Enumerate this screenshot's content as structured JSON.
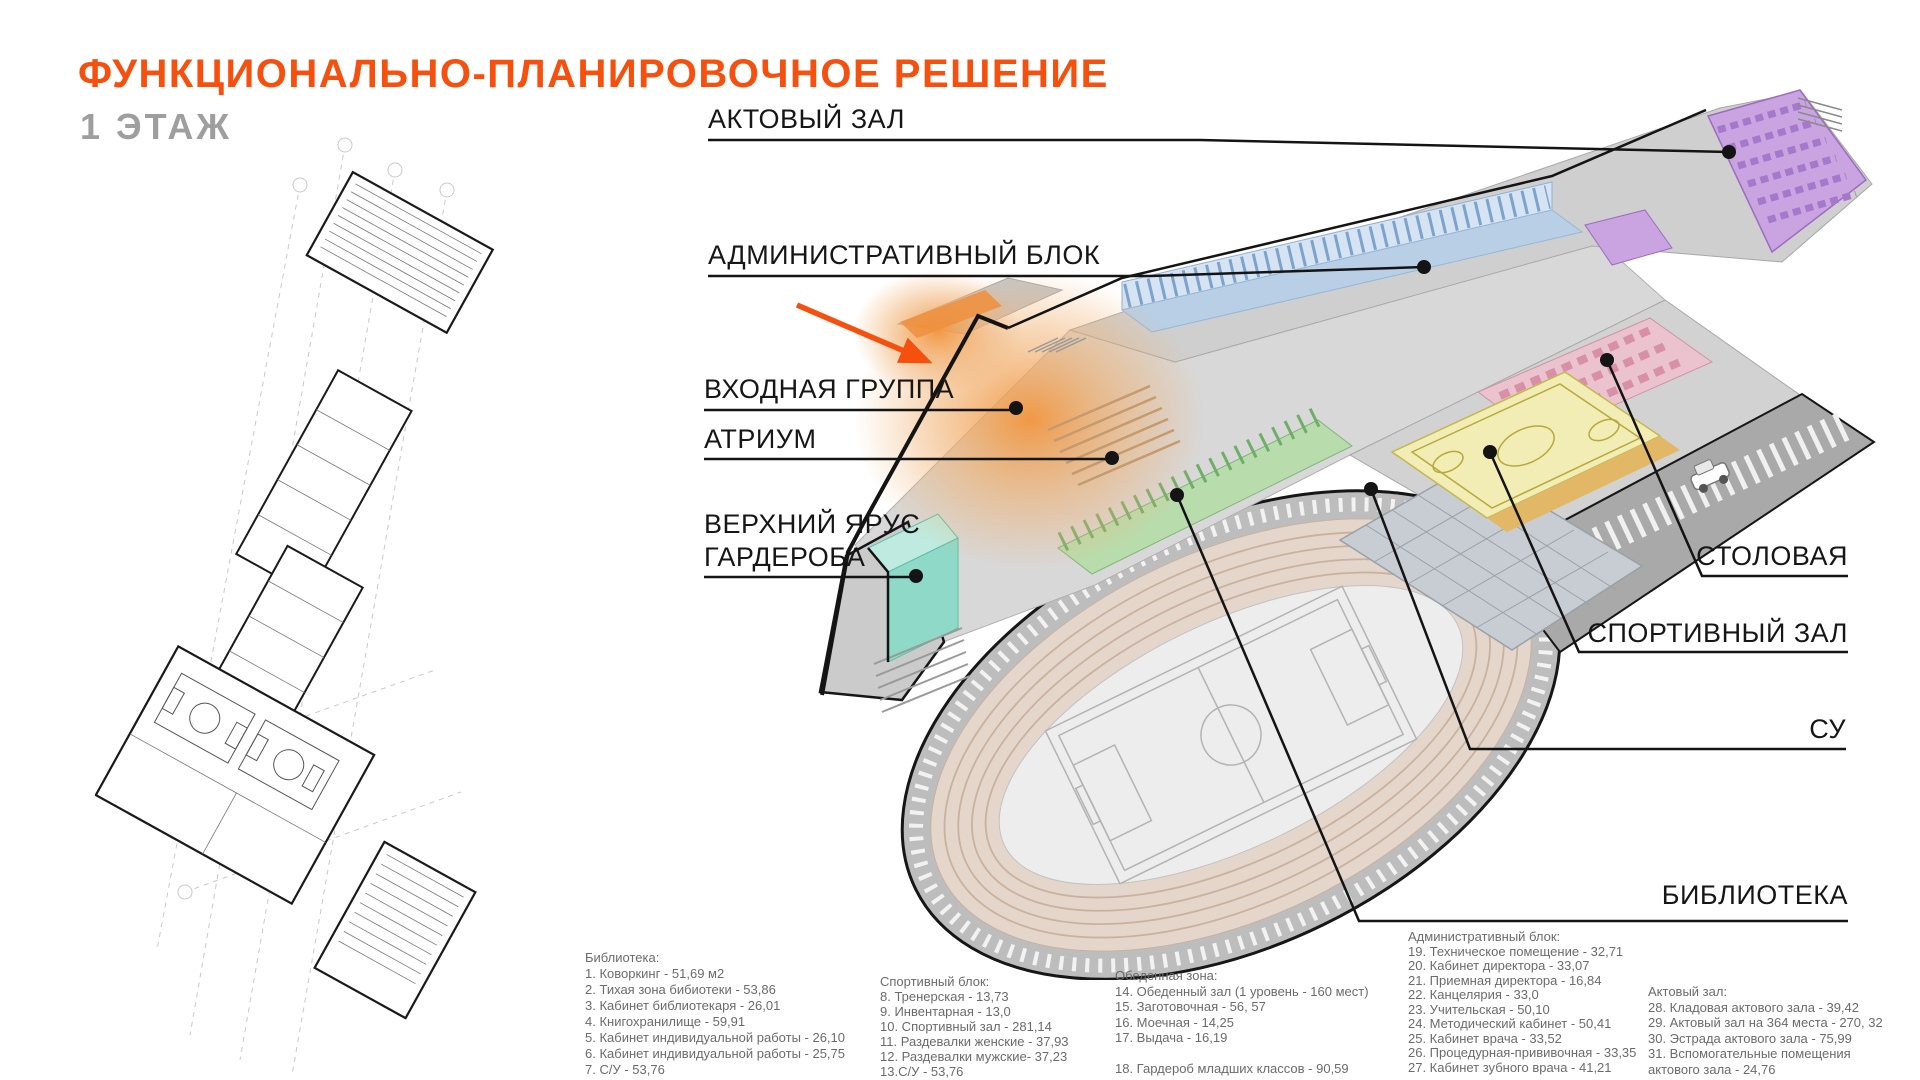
{
  "header": {
    "title": "ФУНКЦИОНАЛЬНО-ПЛАНИРОВОЧНОЕ РЕШЕНИЕ",
    "subtitle": "1 ЭТАЖ"
  },
  "colors": {
    "accent": "#f6500f",
    "subtitle_gray": "#9e9e9e",
    "label_text": "#161616",
    "legend_text": "#6b6b6b",
    "arrow": "#f6500f"
  },
  "labels": {
    "assembly": "АКТОВЫЙ ЗАЛ",
    "admin": "АДМИНИСТРАТИВНЫЙ БЛОК",
    "entrance": "ВХОДНАЯ ГРУППА",
    "atrium": "АТРИУМ",
    "wardrobe": "ВЕРХНИЙ ЯРУС\nГАРДЕРОБА",
    "dining": "СТОЛОВАЯ",
    "sport": "СПОРТИВНЫЙ ЗАЛ",
    "su": "СУ",
    "library": "БИБЛИОТЕКА"
  },
  "zones": {
    "assembly_hall": {
      "label": "Актовый зал",
      "color": "#c9a4e0"
    },
    "admin_block": {
      "label": "Административный блок",
      "color": "#b9cfe6"
    },
    "dining_zone": {
      "label": "Столовая",
      "color": "#eac3cf"
    },
    "sport_hall": {
      "label": "Спортивный зал",
      "color": "#f1edb4"
    },
    "library_zone": {
      "label": "Библиотека",
      "color": "#b9dcac"
    },
    "wardrobe_upper": {
      "label": "Верхний ярус гардероба",
      "color": "#8fd9c8"
    },
    "atrium_entrance": {
      "label": "Входная группа / атриум",
      "color": "#f2953e"
    }
  },
  "legend": {
    "columns": [
      {
        "title": "Библиотека:",
        "items": [
          "1. Коворкинг - 51,69 м2",
          "2. Тихая зона бибиотеки - 53,86",
          "3. Кабинет библиотекаря - 26,01",
          "4. Книгохранилище - 59,91",
          "5. Кабинет индивидуальной работы - 26,10",
          "6. Кабинет индивидуальной работы - 25,75",
          "7. С/У - 53,76"
        ]
      },
      {
        "title": "Спортивный блок:",
        "items": [
          "8. Тренерская - 13,73",
          "9. Инвентарная - 13,0",
          "10. Спортивный зал - 281,14",
          "11. Раздевалки женские - 37,93",
          "12. Раздевалки мужские- 37,23",
          "13.С/У - 53,76"
        ]
      },
      {
        "title": "Обеденная зона:",
        "items": [
          "14. Обеденный зал (1 уровень - 160 мест)",
          "15. Заготовочная - 56, 57",
          "16. Моечная - 14,25",
          "17. Выдача - 16,19",
          "",
          "18. Гардероб младших классов - 90,59"
        ]
      },
      {
        "title": "Административный блок:",
        "items": [
          "19. Техническое помещение - 32,71",
          "20. Кабинет директора - 33,07",
          "21. Приемная директора - 16,84",
          "22. Канцелярия - 33,0",
          "23. Учительская - 50,10",
          "24. Методический кабинет - 50,41",
          "25. Кабинет врача - 33,52",
          "26. Процедурная-прививочная - 33,35",
          "27. Кабинет зубного врача - 41,21"
        ]
      },
      {
        "title": "Актовый зал:",
        "items": [
          "28. Кладовая актового зала - 39,42",
          "29. Актовый зал на 364 места - 270, 32",
          "30. Эстрада актового зала - 75,99",
          "31. Вспомогательные помещения актового зала - 24,76"
        ]
      }
    ]
  }
}
